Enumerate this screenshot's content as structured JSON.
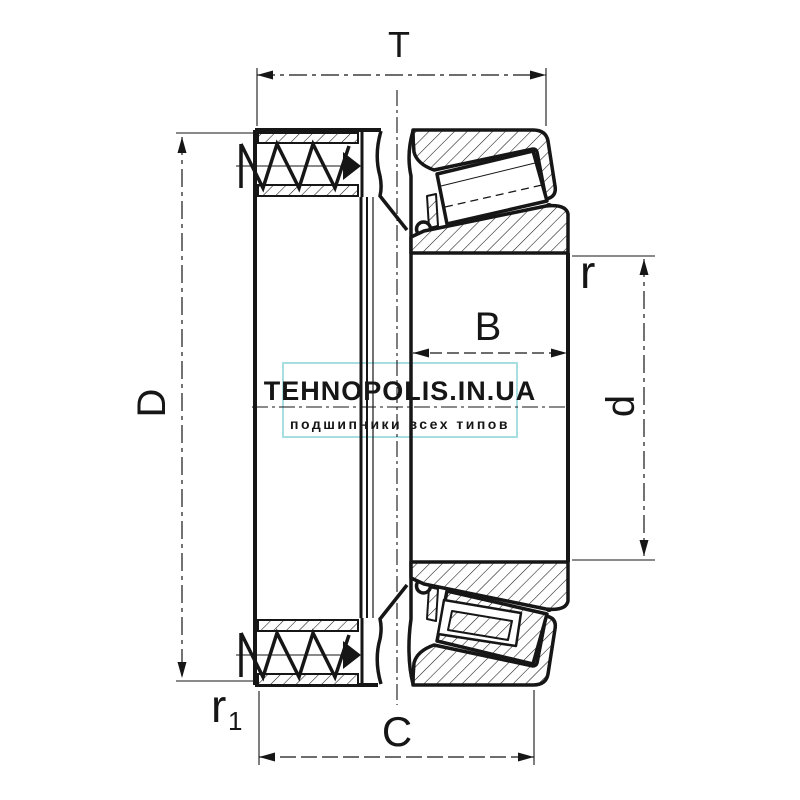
{
  "labels": {
    "T": "T",
    "D": "D",
    "B": "B",
    "r": "r",
    "d": "d",
    "C": "C",
    "r1_base": "r",
    "r1_sub": "1"
  },
  "watermark": {
    "title": "TEHNOPOLIS.IN.UA",
    "subtitle": "подшипники всех типов",
    "title_color": "#c9d04c",
    "subtitle_color": "#d5da6c",
    "border_color": "#a8dde2"
  },
  "drawing": {
    "ink_color": "#161616",
    "background": "#ffffff"
  }
}
